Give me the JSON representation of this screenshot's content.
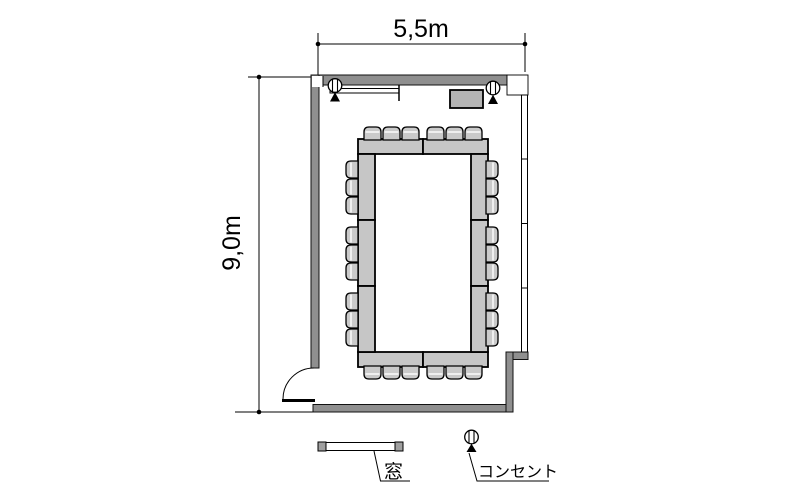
{
  "title": "meeting-room-floor-plan",
  "dimensions": {
    "width_label": "5,5m",
    "height_label": "9,0m"
  },
  "legend": {
    "window_label": "窓",
    "outlet_label": "コンセント"
  },
  "furniture": {
    "layout": "hollow-rectangle-conference",
    "tables": {
      "top": 2,
      "bottom": 2,
      "left": 3,
      "right": 3
    },
    "chairs": {
      "top": 6,
      "bottom": 6,
      "left": 9,
      "right": 9,
      "total": 30
    },
    "outlets": 2,
    "windows": 1,
    "doors": 1
  },
  "colors": {
    "wall": "#8f8f8f",
    "table": "#c6c6c6",
    "chair": "#cacaca",
    "equipment": "#b5b5b5",
    "window_cap": "#a0a0a0",
    "line": "#000000",
    "background": "#ffffff"
  }
}
